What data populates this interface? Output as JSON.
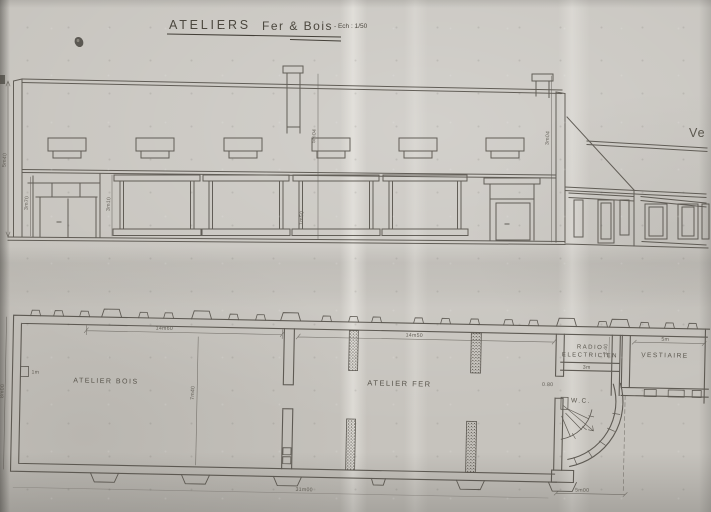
{
  "title": {
    "workshop": "ATELIERS",
    "materials": "Fer & Bois",
    "scale_note": "- Ech : 1/50"
  },
  "elevation": {
    "annotation_right": "Ve",
    "dims": {
      "total_height": "5m40",
      "left_wall": "3m70",
      "left_door": "3m10",
      "window": "1m50",
      "chimney_left": "5m04",
      "chimney_right": "3m04"
    }
  },
  "plan": {
    "rooms": {
      "bois": "ATELIER  BOIS",
      "fer": "ATELIER  FER",
      "radio1": "RADIO",
      "radio2": "ELECTRICIEN",
      "vestiaire": "VESTIAIRE",
      "wc": "W.C."
    },
    "dims": {
      "bois_length": "14m60",
      "fer_length": "14m50",
      "depth": "7m40",
      "left_height": "8m00",
      "niche": "1m",
      "overall": "31m00",
      "wc": "5m00",
      "radio_w": "3m",
      "radio_d": "2.40",
      "vest_w": "5m",
      "door": "0.80"
    }
  },
  "colors": {
    "paper": "#c6c3bd",
    "ink": "#534f48",
    "ink_light": "#5a564e"
  }
}
